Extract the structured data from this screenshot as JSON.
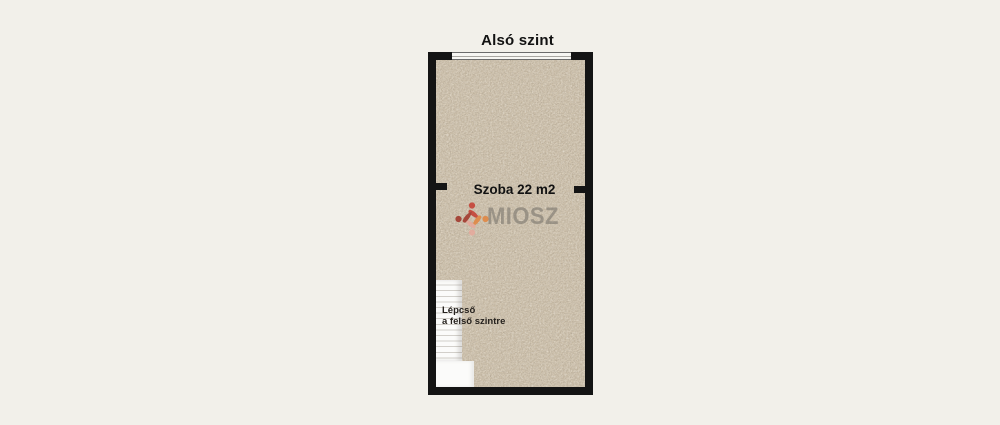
{
  "floorplan": {
    "title": "Alsó szint",
    "room": {
      "label": "Szoba 22 m2",
      "area_m2": 22
    },
    "stairs": {
      "label_line1": "Lépcső",
      "label_line2": "a felső szintre",
      "steps_visible": 14
    },
    "window": {
      "side": "top"
    },
    "watermark": {
      "text": "MIOSZ"
    },
    "colors": {
      "background": "#f2f0ea",
      "wall": "#141414",
      "floor": "#d5c8b2",
      "stairs": "#fbfbfa",
      "step-line": "#d2cfca",
      "watermark-gray": "#7d7870",
      "logo-dark-red": "#9e2d22",
      "logo-red": "#c5372c",
      "logo-orange": "#e2823a",
      "logo-salmon": "#e7a89b"
    }
  }
}
